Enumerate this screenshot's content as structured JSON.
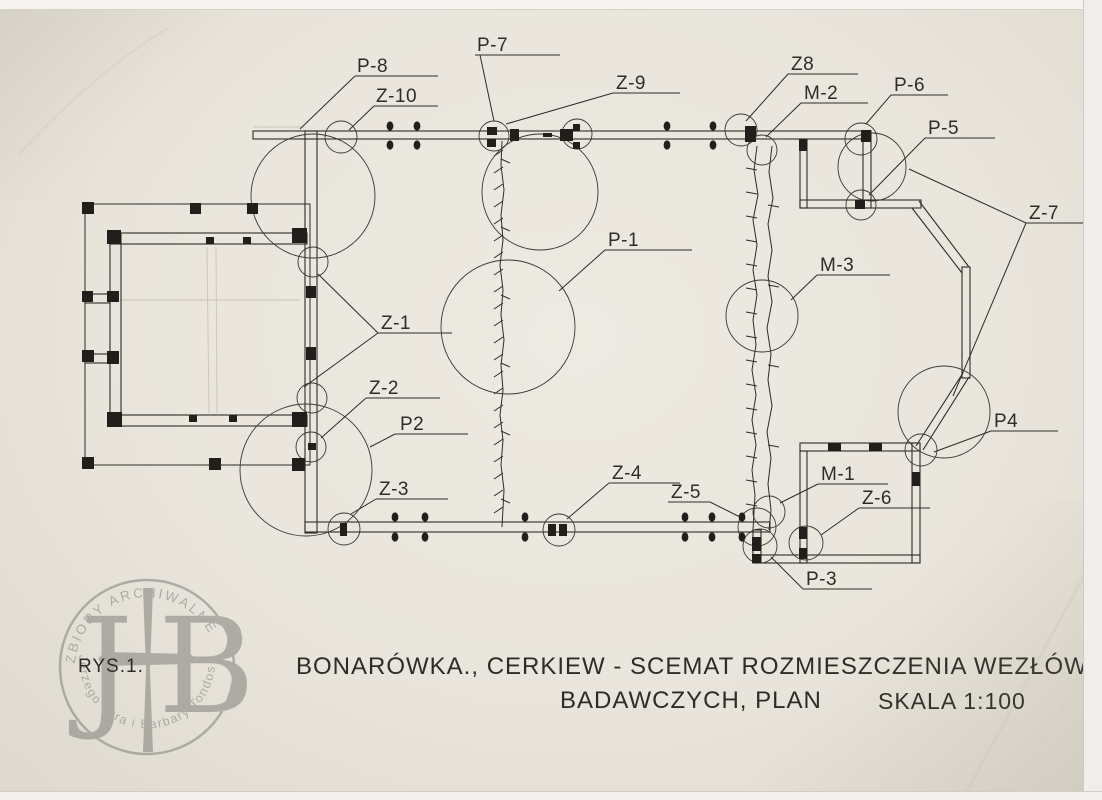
{
  "figure": {
    "number": "RYS.1."
  },
  "caption": {
    "line1": "BONARÓWKA., CERKIEW - SCEMAT ROZMIESZCZENIA WEZŁÓW",
    "line2": "BADAWCZYCH, PLAN",
    "scale": "SKALA 1:100"
  },
  "node_labels": {
    "p8": "P-8",
    "z10": "Z-10",
    "p7": "P-7",
    "z9": "Z-9",
    "z8": "Z8",
    "m2": "M-2",
    "p6": "P-6",
    "p5": "P-5",
    "z7": "Z-7",
    "p1": "P-1",
    "m3": "M-3",
    "z1": "Z-1",
    "z2": "Z-2",
    "p2": "P2",
    "z3": "Z-3",
    "z4": "Z-4",
    "z5": "Z-5",
    "m1": "M-1",
    "z6": "Z-6",
    "p3": "P-3",
    "p4": "P4"
  },
  "stamp": {
    "arc_top": "ZBIORY ARCHIWALNE",
    "arc_bottom": "Jerzego Tura i Barbary Tondos",
    "monogram_left": "J",
    "monogram_right": "B"
  },
  "colors": {
    "paper": "#e9e5dc",
    "ink": "#2e2c28",
    "stamp_gray": "#85857f"
  }
}
